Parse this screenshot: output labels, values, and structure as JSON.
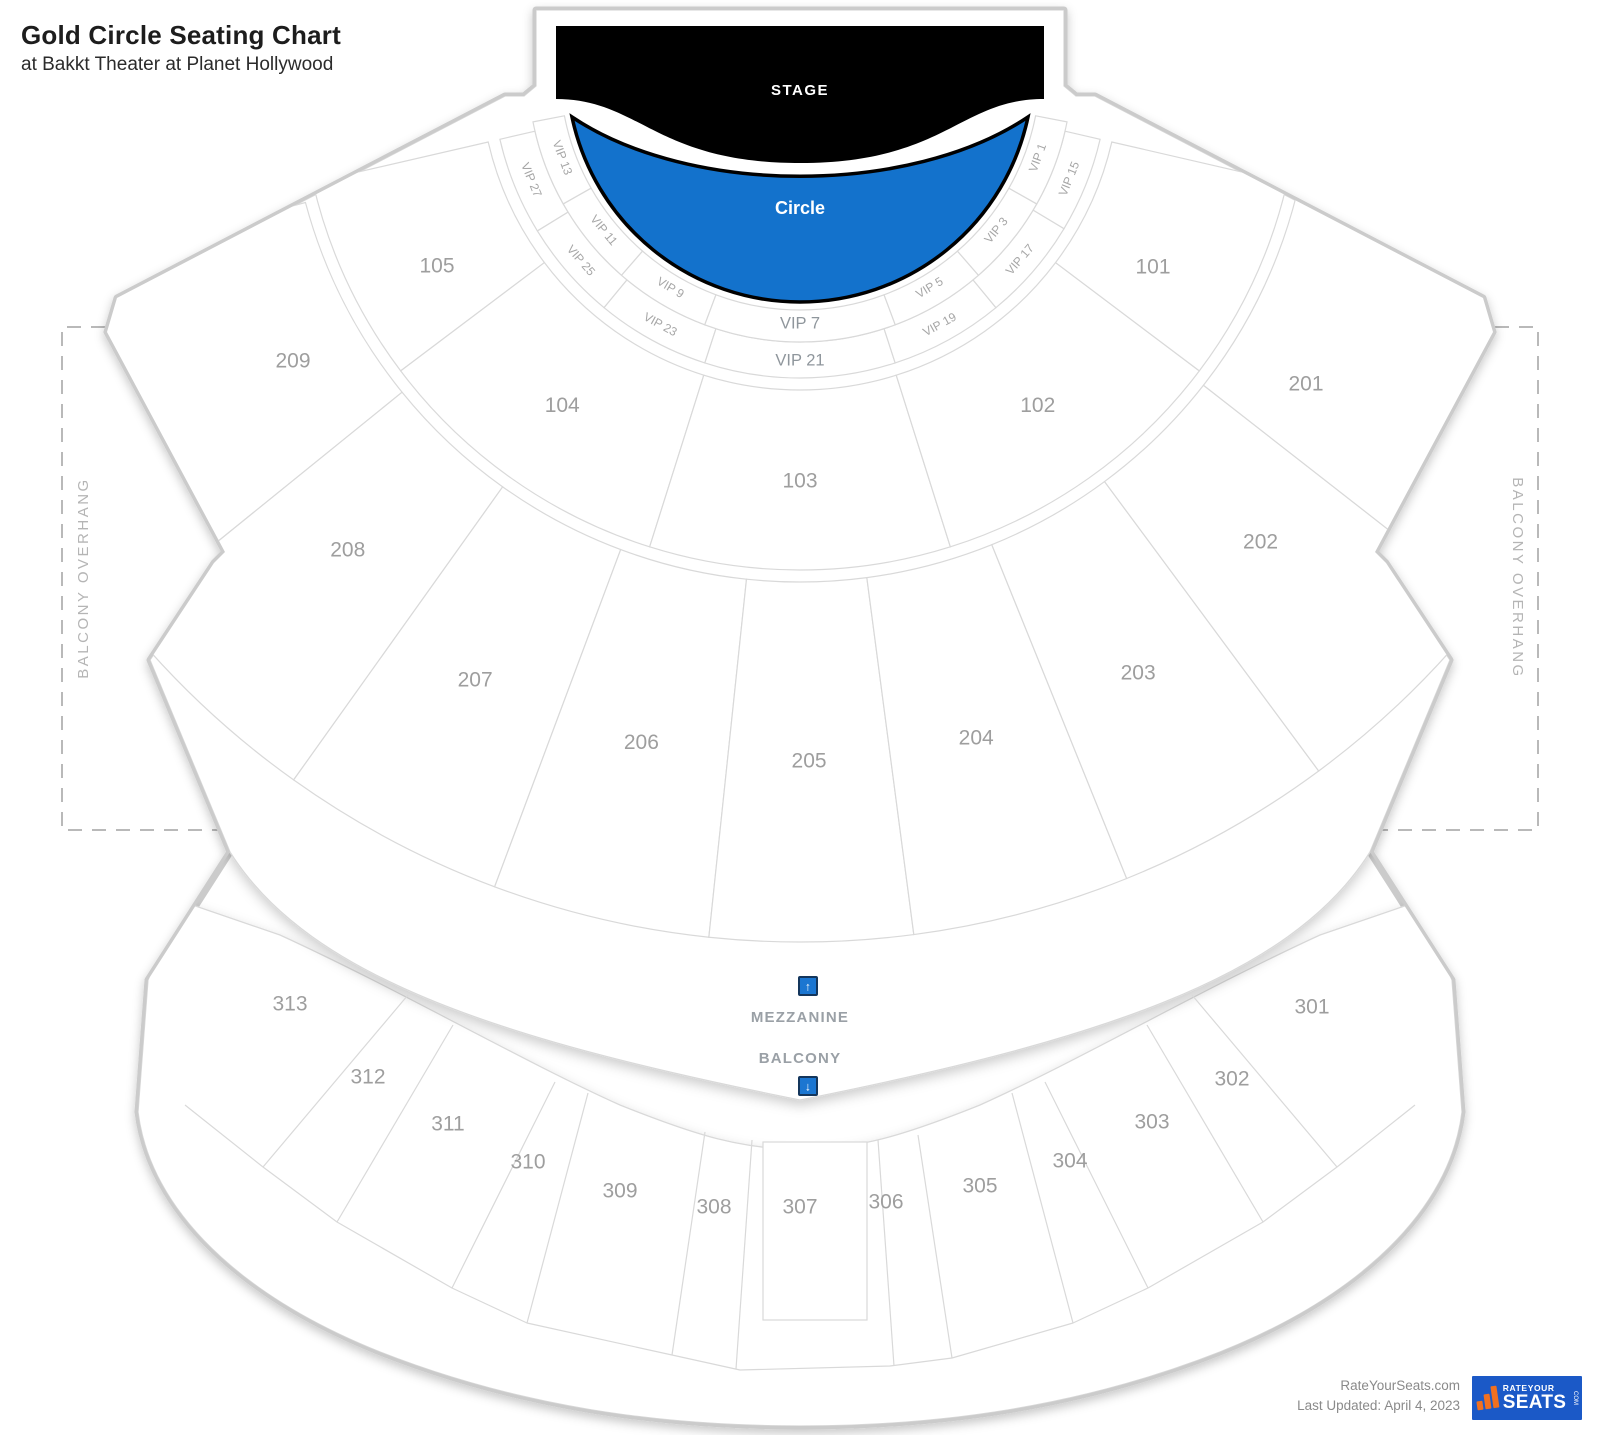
{
  "header": {
    "title": "Gold Circle Seating Chart",
    "subtitle": "at Bakkt Theater at Planet Hollywood"
  },
  "stage": {
    "label": "STAGE",
    "color": "#000000"
  },
  "circle": {
    "label": "Circle",
    "color": "#1372cc"
  },
  "vip": {
    "inner": [
      "VIP 13",
      "VIP 11",
      "VIP 9",
      "VIP 7",
      "VIP 5",
      "VIP 3",
      "VIP 1"
    ],
    "outer": [
      "VIP 27",
      "VIP 25",
      "VIP 23",
      "VIP 21",
      "VIP 19",
      "VIP 17",
      "VIP 15"
    ]
  },
  "floor": {
    "ring1": [
      "105",
      "104",
      "103",
      "102",
      "101"
    ],
    "ring2": [
      "209",
      "208",
      "207",
      "206",
      "205",
      "204",
      "203",
      "202",
      "201"
    ]
  },
  "balcony_sections": [
    "313",
    "312",
    "311",
    "310",
    "309",
    "308",
    "307",
    "306",
    "305",
    "304",
    "303",
    "302",
    "301"
  ],
  "overhang": {
    "label": "BALCONY OVERHANG"
  },
  "levels": {
    "mezzanine": "MEZZANINE",
    "balcony": "BALCONY",
    "up_icon": "↑",
    "down_icon": "↓",
    "icon_color": "#1b76d1"
  },
  "footer": {
    "site": "RateYourSeats.com",
    "updated": "Last Updated: April 4, 2023",
    "logo": {
      "line1": "RATEYOUR",
      "line2": "SEATS",
      "suffix": "COM",
      "bg": "#1b59c7",
      "accent": "#f07020"
    }
  }
}
